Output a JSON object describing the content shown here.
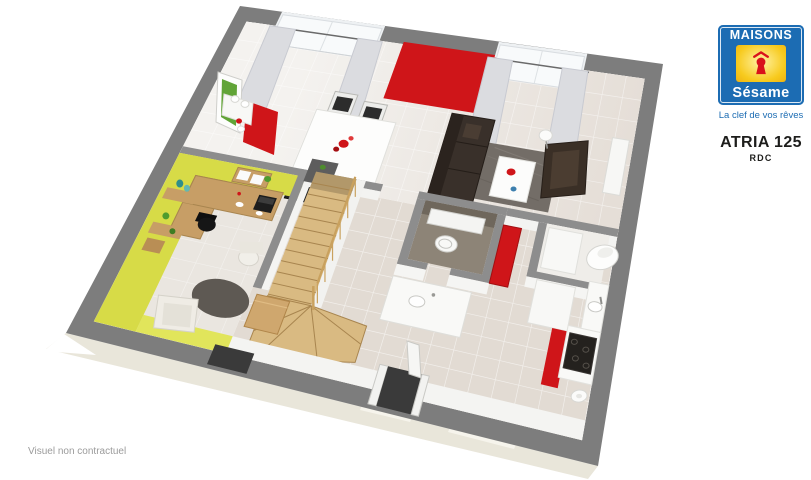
{
  "logo": {
    "brand_top": "MAISONS",
    "brand_bottom": "Sésame",
    "tagline": "La clef de vos rêves"
  },
  "plan": {
    "model": "ATRIA 125",
    "level": "RDC"
  },
  "footer": {
    "disclaimer": "Visuel non contractuel"
  },
  "colors": {
    "logo_blue": "#1c6cb3",
    "logo_yellow": "#f6c91c",
    "keyhole_red": "#d9121b",
    "accent_red": "#cf1519",
    "red_dark": "#a21012",
    "wall_gray": "#7d7d7d",
    "wall_top": "#8d8d8d",
    "office_yellow": "#d7db47",
    "office_yellow_light": "#e1e55b",
    "floor_beige": "#e2dbd3",
    "floor_office": "#eae6e0",
    "slab_cream": "#e9e6da",
    "wood": "#d9ba82",
    "wood_dark": "#a8854f",
    "wood_mid": "#c9a15e",
    "desk_wood": "#c79e66",
    "sofa_brown": "#39302a",
    "rug_gray": "#736d67",
    "rug_round": "#5e5953",
    "wc_floor": "#8d8477",
    "text_gray": "#9b9b9b"
  }
}
